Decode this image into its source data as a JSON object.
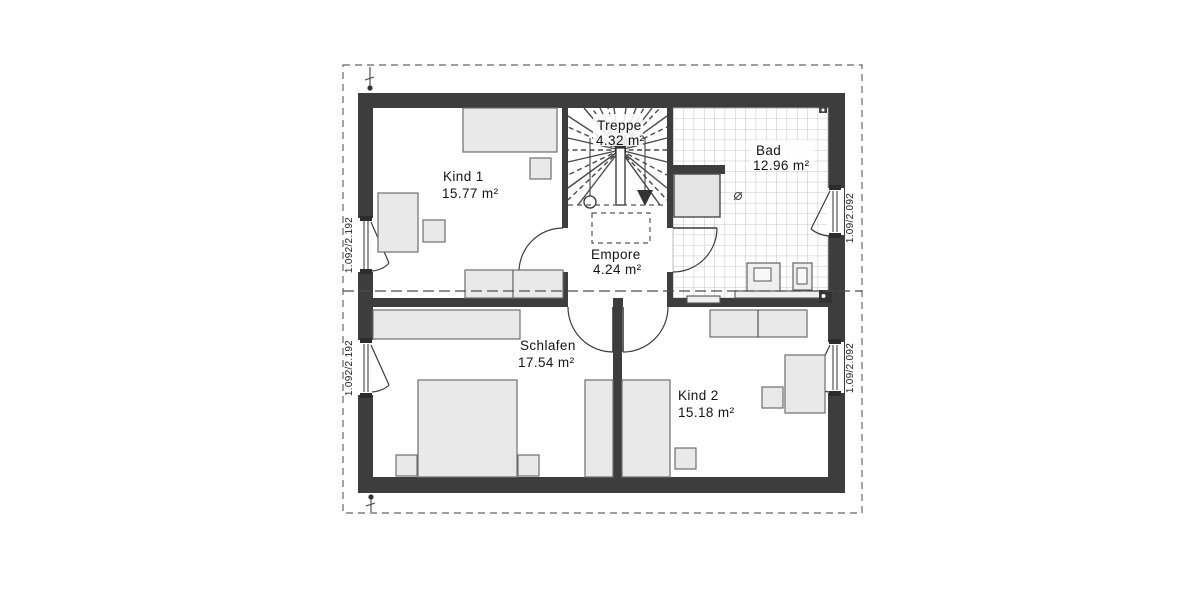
{
  "drawing": {
    "type": "floor-plan",
    "floor": "upper-floor",
    "language": "de"
  },
  "rooms": [
    {
      "id": "kind1",
      "name": "Kind 1",
      "area": "15.77 m²"
    },
    {
      "id": "treppe",
      "name": "Treppe",
      "area": "4.32 m²"
    },
    {
      "id": "bad",
      "name": "Bad",
      "area": "12.96 m²"
    },
    {
      "id": "empore",
      "name": "Empore",
      "area": "4.24 m²"
    },
    {
      "id": "schlafen",
      "name": "Schlafen",
      "area": "17.54 m²"
    },
    {
      "id": "kind2",
      "name": "Kind 2",
      "area": "15.18 m²"
    }
  ],
  "windows": [
    {
      "id": "left-kind1",
      "size": "1.092/2.192"
    },
    {
      "id": "left-schlafen",
      "size": "1.092/2.192"
    },
    {
      "id": "right-bad",
      "size": "1.09/2.092"
    },
    {
      "id": "right-kind2",
      "size": "1.09/2.092"
    }
  ],
  "colors": {
    "wall": "#3d3d3d",
    "furniture_fill": "#e9e9e9",
    "tile_line": "#b3b3b3",
    "background": "#ffffff"
  }
}
